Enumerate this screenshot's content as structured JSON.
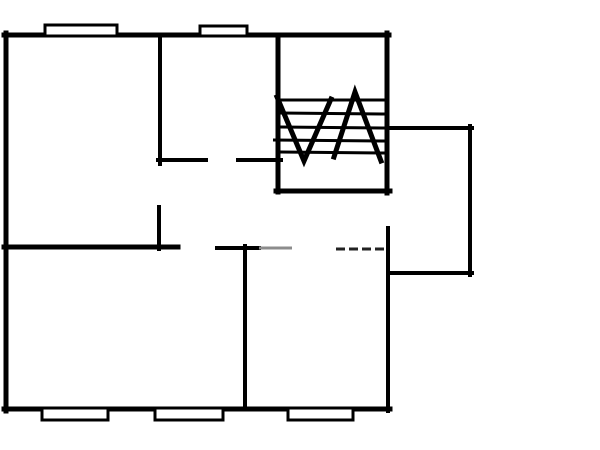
{
  "canvas": {
    "width": 600,
    "height": 450,
    "background_color": "#ffffff",
    "wall_color": "#000000",
    "faint_color": "#8c8c8c",
    "dashed_color": "#222222",
    "window_fill": "#ffffff"
  },
  "floorplan": {
    "walls": [
      {
        "name": "top-exterior-wall",
        "x1": 4,
        "y1": 35,
        "x2": 389,
        "y2": 35,
        "w": 5
      },
      {
        "name": "left-exterior-wall",
        "x1": 6,
        "y1": 33,
        "x2": 6,
        "y2": 411,
        "w": 5
      },
      {
        "name": "bottom-exterior-wall",
        "x1": 4,
        "y1": 409,
        "x2": 390,
        "y2": 409,
        "w": 5
      },
      {
        "name": "right-exterior-wall-upper",
        "x1": 387,
        "y1": 33,
        "x2": 387,
        "y2": 193,
        "w": 5
      },
      {
        "name": "right-exterior-wall-lower",
        "x1": 388,
        "y1": 228,
        "x2": 388,
        "y2": 411,
        "w": 4
      },
      {
        "name": "interior-wall-vertical-upper",
        "x1": 160,
        "y1": 35,
        "x2": 160,
        "y2": 164,
        "w": 4
      },
      {
        "name": "interior-wall-horizontal-left",
        "x1": 158,
        "y1": 160,
        "x2": 206,
        "y2": 160,
        "w": 4
      },
      {
        "name": "interior-wall-horizontal-right",
        "x1": 238,
        "y1": 160,
        "x2": 281,
        "y2": 160,
        "w": 4
      },
      {
        "name": "interior-wall-vertical-stub",
        "x1": 159,
        "y1": 207,
        "x2": 159,
        "y2": 249,
        "w": 4
      },
      {
        "name": "middle-wall-left",
        "x1": 4,
        "y1": 247,
        "x2": 178,
        "y2": 247,
        "w": 5
      },
      {
        "name": "middle-wall-center",
        "x1": 217,
        "y1": 248,
        "x2": 259,
        "y2": 248,
        "w": 4
      },
      {
        "name": "lower-room-divider",
        "x1": 245,
        "y1": 246,
        "x2": 245,
        "y2": 409,
        "w": 4
      },
      {
        "name": "stair-left-wall",
        "x1": 278,
        "y1": 35,
        "x2": 278,
        "y2": 192,
        "w": 5
      },
      {
        "name": "stair-bottom-wall",
        "x1": 276,
        "y1": 191,
        "x2": 390,
        "y2": 191,
        "w": 5
      },
      {
        "name": "annex-top-wall",
        "x1": 388,
        "y1": 128,
        "x2": 472,
        "y2": 128,
        "w": 4
      },
      {
        "name": "annex-right-wall",
        "x1": 470,
        "y1": 126,
        "x2": 470,
        "y2": 275,
        "w": 4
      },
      {
        "name": "annex-bottom-wall",
        "x1": 388,
        "y1": 273,
        "x2": 472,
        "y2": 273,
        "w": 4
      }
    ],
    "faint_walls": [
      {
        "name": "faded-wall-segment",
        "x1": 259,
        "y1": 248,
        "x2": 292,
        "y2": 248,
        "w": 3,
        "dash": "",
        "color_key": "faint_color"
      },
      {
        "name": "dashed-wall-segment",
        "x1": 336,
        "y1": 249,
        "x2": 385,
        "y2": 249,
        "w": 3,
        "dash": "9 4",
        "color_key": "dashed_color"
      }
    ],
    "windows": [
      {
        "name": "window-top-left",
        "x": 45,
        "y": 25,
        "w": 72,
        "h": 11
      },
      {
        "name": "window-top-center",
        "x": 200,
        "y": 26,
        "w": 47,
        "h": 10
      },
      {
        "name": "window-bottom-left",
        "x": 42,
        "y": 408,
        "w": 66,
        "h": 12
      },
      {
        "name": "window-bottom-center",
        "x": 155,
        "y": 408,
        "w": 68,
        "h": 12
      },
      {
        "name": "window-bottom-right",
        "x": 288,
        "y": 408,
        "w": 65,
        "h": 12
      }
    ],
    "stairs": {
      "tread_width": 3,
      "treads": [
        {
          "x1": 280,
          "y1": 100,
          "x2": 386,
          "y2": 100
        },
        {
          "x1": 280,
          "y1": 113,
          "x2": 386,
          "y2": 114
        },
        {
          "x1": 280,
          "y1": 127,
          "x2": 386,
          "y2": 128
        },
        {
          "x1": 273,
          "y1": 140,
          "x2": 386,
          "y2": 141
        },
        {
          "x1": 280,
          "y1": 152,
          "x2": 386,
          "y2": 153
        }
      ],
      "arrow_width": 5,
      "arrows": [
        {
          "name": "stair-zigzag-down",
          "points": "277,97 304,161 331,99"
        },
        {
          "name": "stair-zigzag-up",
          "points": "334,157 355,92 381,161"
        }
      ]
    }
  }
}
